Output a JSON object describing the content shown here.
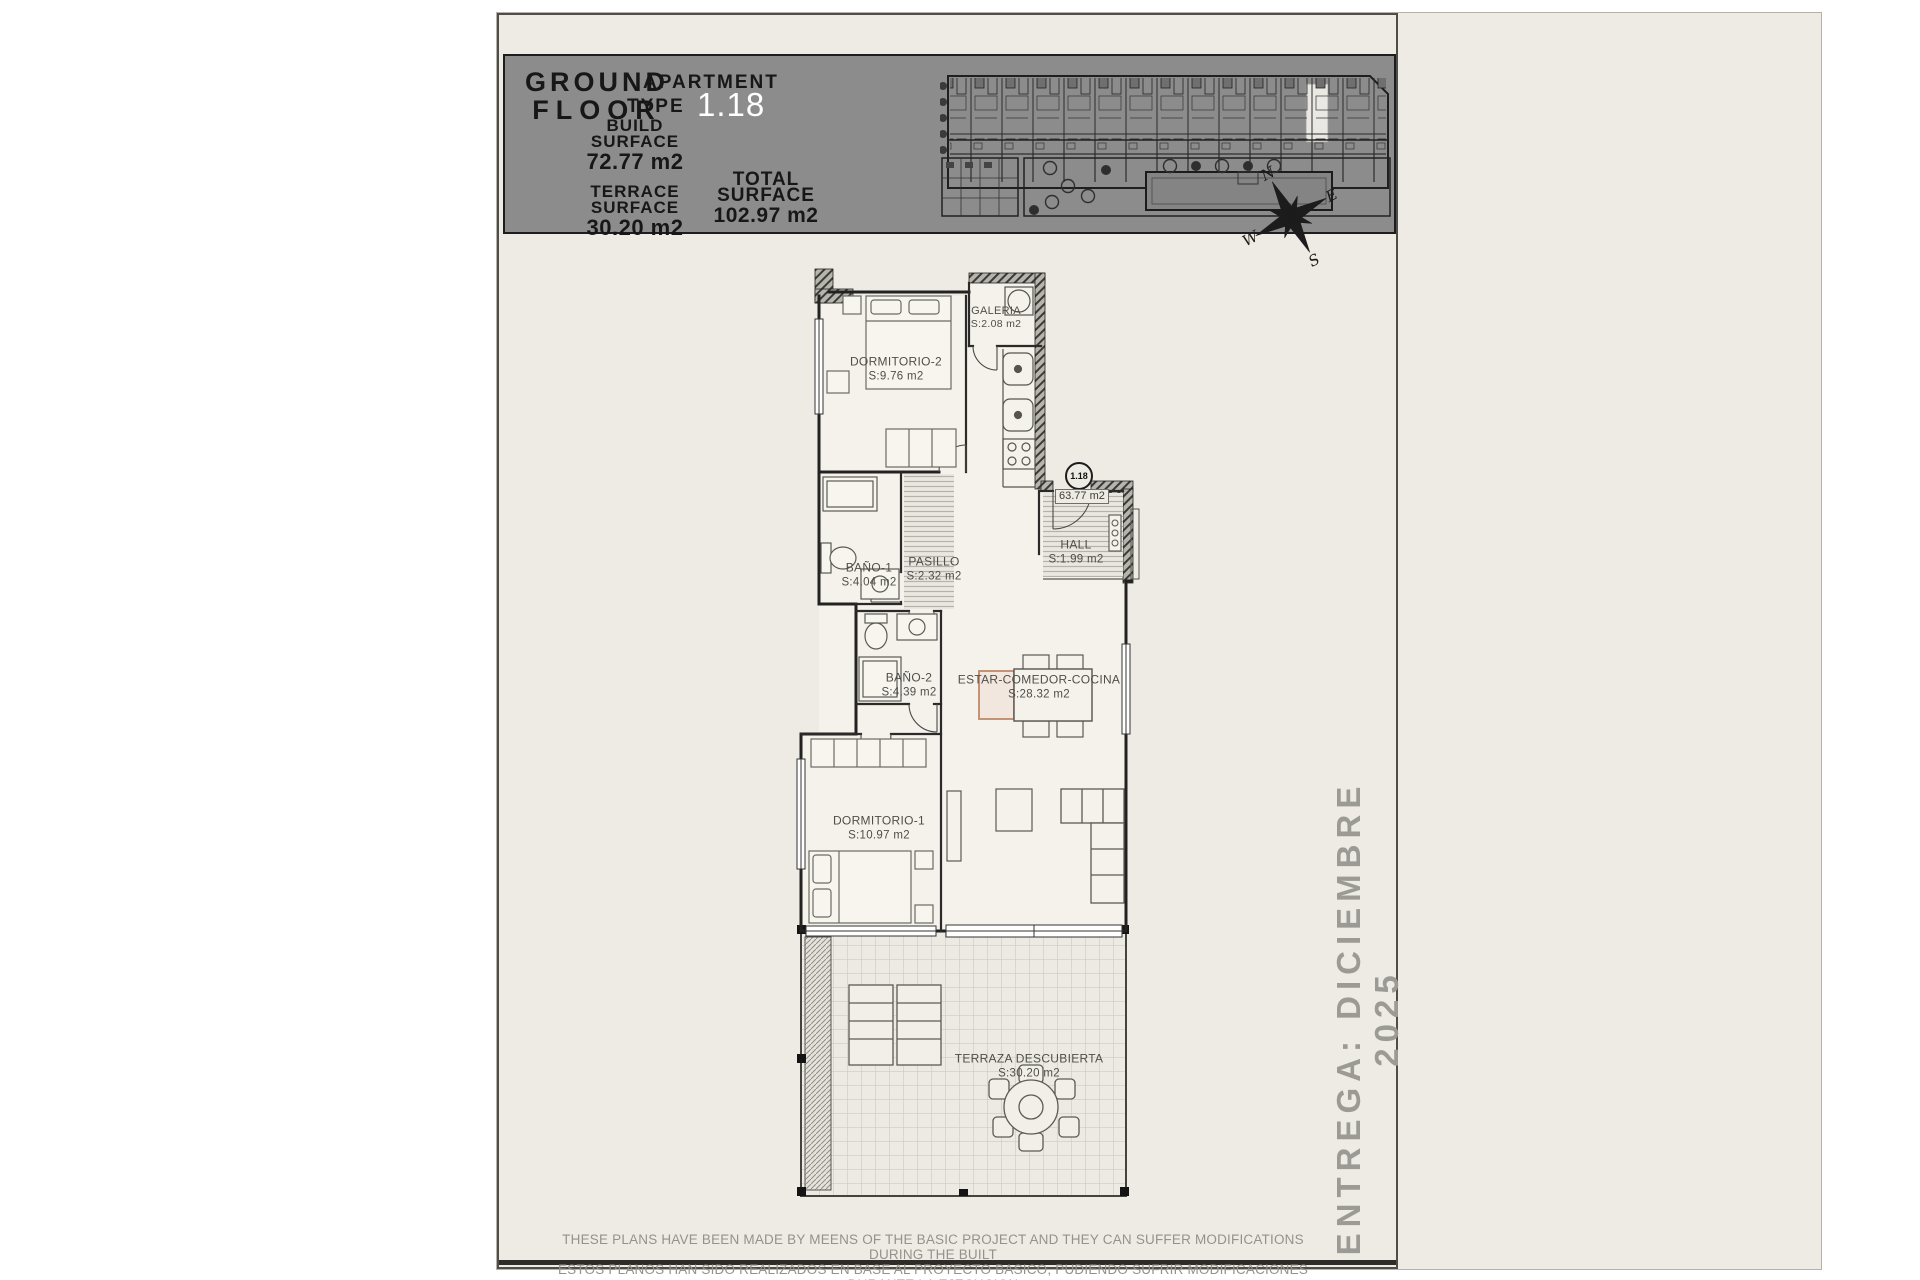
{
  "header": {
    "floor_line1": "GROUND",
    "floor_line2": "FLOOR",
    "build_label_1": "BUILD",
    "build_label_2": "SURFACE",
    "build_value": "72.77 m2",
    "terrace_label_1": "TERRACE",
    "terrace_label_2": "SURFACE",
    "terrace_value": "30.20 m2",
    "apartment_label": "APARTMENT",
    "type_label": "TYPE",
    "type_value": "1.18",
    "total_label_1": "TOTAL",
    "total_label_2": "SURFACE",
    "total_value": "102.97 m2"
  },
  "compass": {
    "north": "N",
    "east": "E",
    "south": "S",
    "west": "W"
  },
  "plan": {
    "unit_number": "1.18",
    "useful_surface": "63.77 m2",
    "rooms": {
      "dormitorio2": {
        "name": "DORMITORIO-2",
        "area": "S:9.76 m2"
      },
      "galeria": {
        "name": "GALERIA",
        "area": "S:2.08 m2"
      },
      "bano1": {
        "name": "BAÑO-1",
        "area": "S:4.04 m2"
      },
      "pasillo": {
        "name": "PASILLO",
        "area": "S:2.32 m2"
      },
      "hall": {
        "name": "HALL",
        "area": "S:1.99 m2"
      },
      "bano2": {
        "name": "BAÑO-2",
        "area": "S:4.39 m2"
      },
      "estar_comedor_cocina": {
        "name": "ESTAR-COMEDOR-COCINA",
        "area": "S:28.32 m2"
      },
      "dormitorio1": {
        "name": "DORMITORIO-1",
        "area": "S:10.97 m2"
      },
      "terraza": {
        "name": "TERRAZA DESCUBIERTA",
        "area": "S:30.20 m2"
      }
    }
  },
  "side_note": "ENTREGA: DICIEMBRE 2025",
  "disclaimer_line1": "THESE PLANS HAVE BEEN MADE BY MEENS OF THE BASIC PROJECT AND THEY CAN SUFFER MODIFICATIONS DURING THE BUILT",
  "disclaimer_line2": "ESTOS PLANOS HAN SIDO REALIZADOS EN BASE AL PROYECTO BASICO, PUDIENDO SUFRIR MODIFICACIONES DURANTE LA EJECUCION",
  "colors": {
    "header_bg": "#8c8c8c",
    "type_text": "#ffffff",
    "sheet_bg": "#edebe4",
    "wall": "#222222",
    "muted_text": "#9b9a94",
    "table_accent": "#bf8a6a"
  }
}
